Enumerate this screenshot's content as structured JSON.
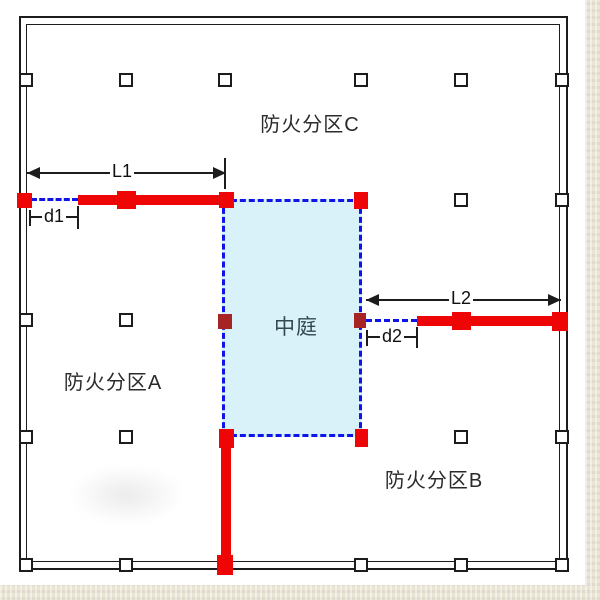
{
  "labels": {
    "zone_c": "防火分区C",
    "zone_a": "防火分区A",
    "zone_b": "防火分区B",
    "atrium": "中庭"
  },
  "dimensions": [
    {
      "id": "l1",
      "label": "L1",
      "type": "arrow",
      "x1": 27,
      "x2": 226,
      "y": 173,
      "lx": 122,
      "ly": 172,
      "ticks": [
        [
          225,
          158,
          189
        ]
      ]
    },
    {
      "id": "l2",
      "label": "L2",
      "type": "arrow",
      "x1": 366,
      "x2": 561,
      "y": 300,
      "lx": 461,
      "ly": 299,
      "ticks": []
    },
    {
      "id": "d1",
      "label": "d1",
      "type": "tick",
      "x1": 30,
      "x2": 78,
      "y": 217,
      "lx": 54,
      "ly": 217,
      "ticks": [
        [
          30,
          210,
          226
        ],
        [
          78,
          206,
          229
        ]
      ]
    },
    {
      "id": "d2",
      "label": "d2",
      "type": "tick",
      "x1": 367,
      "x2": 417,
      "y": 337,
      "lx": 392,
      "ly": 337,
      "ticks": [
        [
          367,
          330,
          346
        ],
        [
          417,
          327,
          348
        ]
      ]
    }
  ],
  "colors": {
    "line": "#1c1c1c",
    "red": "#ee0505",
    "dark_red": "#a62424",
    "blue_dash": "#0f14e8",
    "atrium_fill": "#d9f1f8",
    "canvas": "#ffffff",
    "backdrop": "#e9e4d4"
  },
  "plan": {
    "columns": [
      [
        26,
        80
      ],
      [
        126,
        80
      ],
      [
        225,
        80
      ],
      [
        361,
        80
      ],
      [
        461,
        80
      ],
      [
        562,
        80
      ],
      [
        461,
        200
      ],
      [
        562,
        200
      ],
      [
        26,
        320
      ],
      [
        126,
        320
      ],
      [
        26,
        437
      ],
      [
        126,
        437
      ],
      [
        461,
        437
      ],
      [
        562,
        437
      ],
      [
        26,
        565
      ],
      [
        126,
        565
      ],
      [
        361,
        565
      ],
      [
        461,
        565
      ],
      [
        562,
        565
      ]
    ],
    "red_squares": [
      [
        24,
        200,
        15,
        15
      ],
      [
        126,
        200,
        19,
        18
      ],
      [
        226,
        200,
        15,
        16
      ],
      [
        361,
        200,
        14,
        17
      ],
      [
        226,
        438,
        15,
        19
      ],
      [
        361,
        438,
        13,
        18
      ],
      [
        461,
        321,
        19,
        18
      ],
      [
        560,
        321,
        16,
        19
      ],
      [
        225,
        565,
        16,
        20
      ]
    ],
    "dark_squares": [
      [
        225,
        321,
        14,
        15
      ],
      [
        360,
        320,
        12,
        15
      ]
    ],
    "red_bars": [
      [
        78,
        195,
        152,
        10
      ],
      [
        417,
        316,
        151,
        10
      ],
      [
        221,
        444,
        10,
        118
      ]
    ],
    "dash_segments": [
      [
        31,
        199,
        78
      ],
      [
        366,
        320,
        417
      ]
    ],
    "atrium": [
      222,
      199,
      140,
      238
    ]
  }
}
